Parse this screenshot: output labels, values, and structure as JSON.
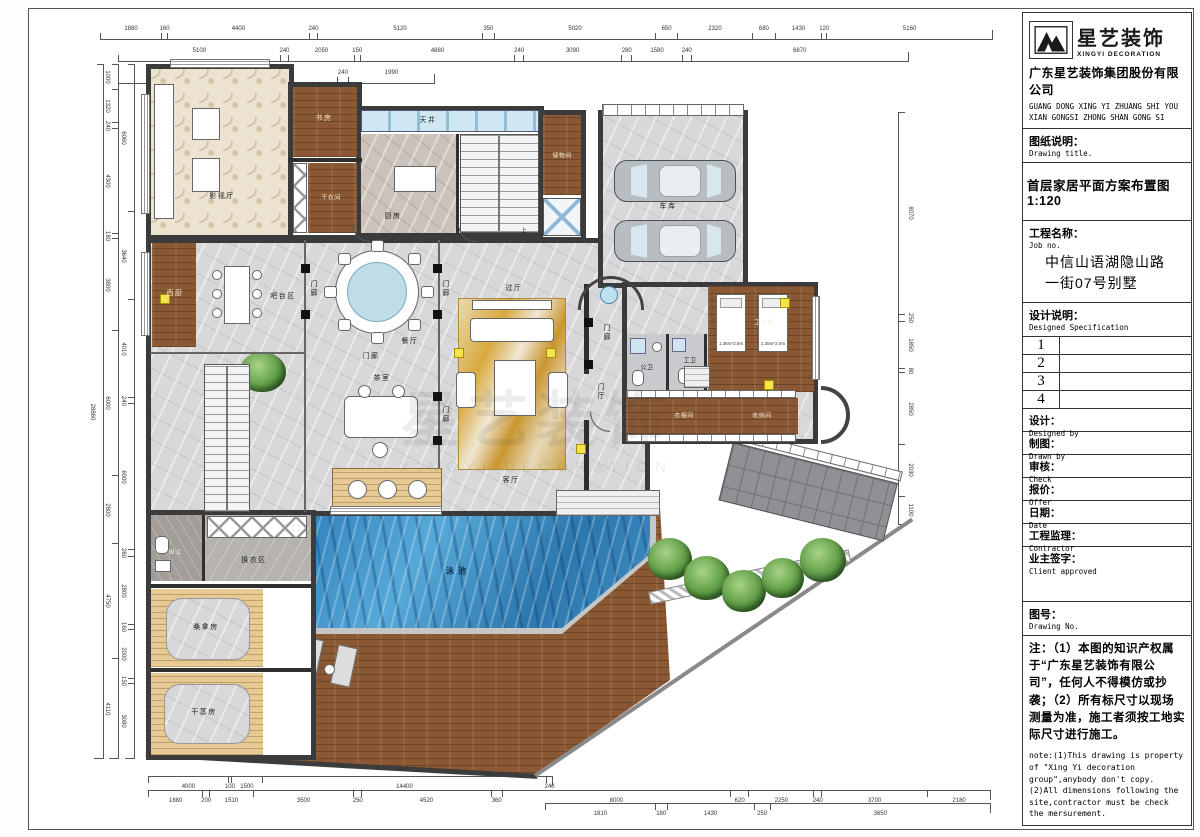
{
  "title_block": {
    "logo_text": "星艺装饰",
    "logo_sub": "XINGYI DECORATION",
    "company_cn": "广东星艺装饰集团股份有限公司",
    "company_en1": "GUANG DONG XING YI ZHUANG SHI YOU",
    "company_en2": "XIAN GONGSI ZHONG SHAN GONG SI",
    "drawing_title_label_cn": "图纸说明：",
    "drawing_title_label_en": "Drawing title.",
    "drawing_title": "首层家居平面方案布置图 1:120",
    "project_label_cn": "工程名称：",
    "project_label_en": "Job  no.",
    "project_name_line1": "中信山语湖隐山路",
    "project_name_line2": "一街07号别墅",
    "spec_label_cn": "设计说明：",
    "spec_label_en": "Designed Specification",
    "rows": [
      "1",
      "2",
      "3",
      "4"
    ],
    "fields": [
      {
        "cn": "设计：",
        "en": "Designed by"
      },
      {
        "cn": "制图：",
        "en": "Drawn by"
      },
      {
        "cn": "审核：",
        "en": "Check"
      },
      {
        "cn": "报价：",
        "en": "Offer"
      },
      {
        "cn": "日期：",
        "en": "Date"
      },
      {
        "cn": "工程监理：",
        "en": "Contractor"
      },
      {
        "cn": "业主签字：",
        "en": "Client approved"
      }
    ],
    "drawing_no_cn": "图号：",
    "drawing_no_en": "Drawing No.",
    "note_cn": "注：（1）本图的知识产权属于“广东星艺装饰有限公司”，任何人不得模仿或抄袭；（2）所有标尺寸以现场测量为准，施工者须按工地实际尺寸进行施工。",
    "note_en": "note:(1)This drawing is property of \"Xing Yi decoration group\",anybody don't copy. (2)All dimensions following the site,contractor must be check the mersurement."
  },
  "rooms": {
    "cinema": "影视厅",
    "study": "书房",
    "laundry": "干衣间",
    "skylight": "天井",
    "kitchen": "厨房",
    "storage_top": "储物间",
    "garage": "车库",
    "west_kitchen": "西厨",
    "bar_area": "吧台区",
    "dining": "餐厅",
    "tea_room": "茶室",
    "pass_hall": "过厅",
    "living": "客厅",
    "foyer": "门厅",
    "porch": "门廊",
    "wc_public": "公卫",
    "wc_staff": "工卫",
    "staff_room": "工人房",
    "cloak": "衣帽间",
    "storage2": "收纳间",
    "wc": "W.C",
    "changing": "换衣区",
    "sauna": "桑拿房",
    "steam": "干蒸房",
    "pool": "泳池",
    "up": "上"
  },
  "furniture": {
    "bed_size": "1.35m*2.0m"
  },
  "watermark": {
    "cn": "星艺装饰",
    "en": "XINGYI DECORATION"
  },
  "dimensions": {
    "top1": [
      "1880",
      "160",
      "4400",
      "240",
      "5120",
      "350",
      "5020",
      "650",
      "2320",
      "680",
      "1430",
      "120",
      "5160"
    ],
    "top2": [
      "5100",
      "240",
      "2050",
      "150",
      "4880",
      "240",
      "3090",
      "280",
      "1580",
      "240",
      "6870"
    ],
    "top3": [
      "5100",
      "240",
      "1990"
    ],
    "bottom1": [
      "4000",
      "100",
      "1500",
      "14400",
      "240"
    ],
    "bottom2": [
      "1880",
      "200",
      "1510",
      "3500",
      "250",
      "4520",
      "360",
      "8000",
      "620",
      "2250",
      "240",
      "3700",
      "2180"
    ],
    "bottom3": [
      "1810",
      "180",
      "1430",
      "250",
      "3650"
    ],
    "left1": [
      "28860"
    ],
    "left2": [
      "1000",
      "1320",
      "240",
      "4300",
      "180",
      "3800",
      "6000",
      "2800",
      "4750",
      "4110"
    ],
    "left3": [
      "6060",
      "3640",
      "4010",
      "240",
      "6000",
      "260",
      "2800",
      "160",
      "2000",
      "150",
      "3080"
    ],
    "right1": [
      "8070",
      "250",
      "1850",
      "80",
      "2850",
      "2030",
      "1100"
    ]
  }
}
